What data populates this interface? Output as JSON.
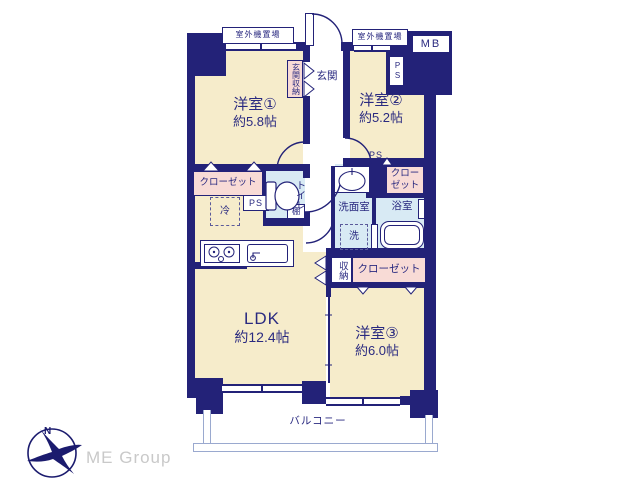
{
  "rooms": {
    "bedroom1": {
      "name": "洋室①",
      "size": "約5.8帖"
    },
    "bedroom2": {
      "name": "洋室②",
      "size": "約5.2帖"
    },
    "bedroom3": {
      "name": "洋室③",
      "size": "約6.0帖"
    },
    "ldk": {
      "name": "LDK",
      "size": "約12.4帖"
    },
    "entrance": "玄関",
    "entrance_storage": "玄関収納",
    "toilet": "トイレ",
    "washroom": "洗面室",
    "bathroom": "浴室",
    "balcony": "バルコニー"
  },
  "labels": {
    "outdoor_left": "室外機置場",
    "outdoor_right": "室外機置場",
    "mb": "MB",
    "ps_top": "PS",
    "ps_left": "PS",
    "ps_right": "PS",
    "closet1": "クローゼット",
    "closet2a": "クロー",
    "closet2b": "ゼット",
    "closet3": "クローゼット",
    "fridge": "冷",
    "shelf": "棚",
    "washer": "洗",
    "storage": "収納"
  },
  "logo": {
    "company": "ME Group",
    "north": "N"
  },
  "colors": {
    "wall": "#232278",
    "room_fill": "#f6eccb",
    "closet_fill": "#f8dbd6",
    "wet_fill": "#d8eaf4",
    "text": "#2a2a80",
    "logo_gray": "#c9c9c9",
    "railing": "#9aa9cf"
  }
}
